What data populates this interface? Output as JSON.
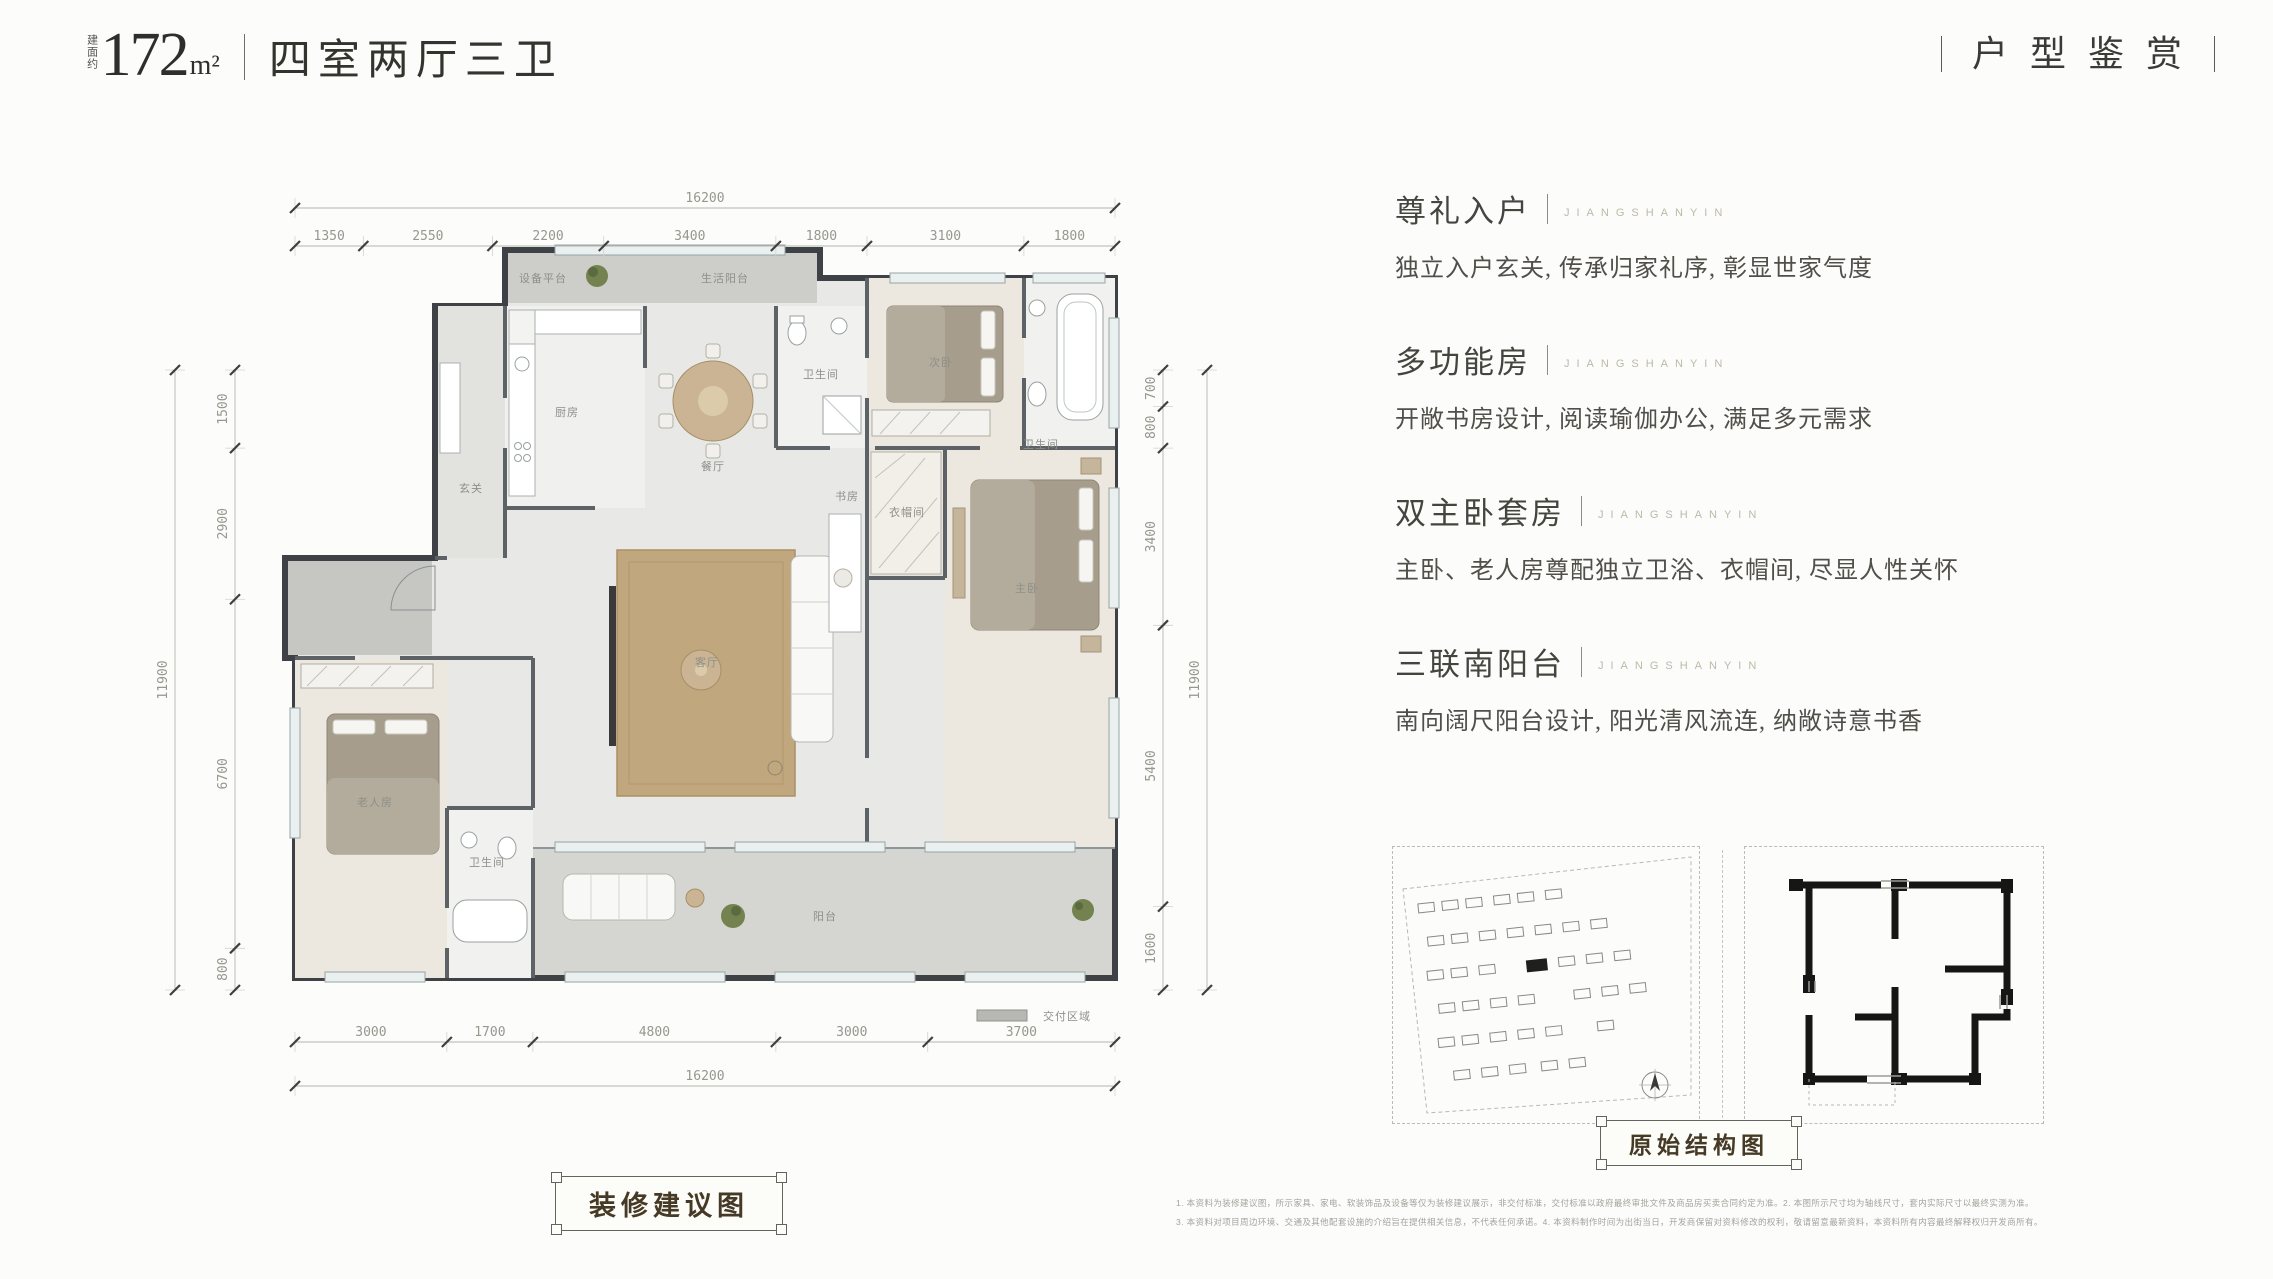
{
  "header": {
    "area_label_vertical": "建面约",
    "area_value": "172",
    "area_unit": "m²",
    "layout_title": "四室两厅三卫",
    "page_title": "户型鉴赏"
  },
  "plan": {
    "dims": {
      "top": {
        "total": "16200",
        "segments": [
          "1350",
          "2550",
          "2200",
          "3400",
          "1800",
          "3100",
          "1800"
        ]
      },
      "bottom": {
        "total": "16200",
        "segments": [
          "3000",
          "1700",
          "4800",
          "3000",
          "3700"
        ]
      },
      "left": {
        "total": "11900",
        "segments": [
          "1500",
          "2900",
          "6700",
          "800"
        ]
      },
      "right": {
        "total": "11900",
        "segments": [
          "700",
          "800",
          "3400",
          "5400",
          "1600"
        ]
      }
    },
    "room_labels": [
      "设备平台",
      "生活阳台",
      "厨房",
      "餐厅",
      "玄关",
      "卫生间",
      "次卧",
      "卫生间",
      "衣帽间",
      "主卧",
      "客厅",
      "书房",
      "老人房",
      "卫生间",
      "阳台"
    ],
    "legend_label": "交付区域",
    "caption": "装修建议图"
  },
  "features": [
    {
      "title": "尊礼入户",
      "tag": "JIANGSHANYIN",
      "desc": "独立入户玄关, 传承归家礼序, 彰显世家气度"
    },
    {
      "title": "多功能房",
      "tag": "JIANGSHANYIN",
      "desc": "开敞书房设计, 阅读瑜伽办公, 满足多元需求"
    },
    {
      "title": "双主卧套房",
      "tag": "JIANGSHANYIN",
      "desc": "主卧、老人房尊配独立卫浴、衣帽间, 尽显人性关怀"
    },
    {
      "title": "三联南阳台",
      "tag": "JIANGSHANYIN",
      "desc": "南向阔尺阳台设计, 阳光清风流连, 纳敞诗意书香"
    }
  ],
  "diagrams": {
    "structure_caption": "原始结构图"
  },
  "disclaimer": {
    "line1": "1. 本资料为装修建议图，所示家具、家电、软装饰品及设备等仅为装修建议展示，非交付标准，交付标准以政府最终审批文件及商品房买卖合同约定为准。2. 本图所示尺寸均为轴线尺寸，套内实际尺寸以最终实测为准。",
    "line2": "3. 本资料对项目周边环境、交通及其他配套设施的介绍旨在提供相关信息，不代表任何承诺。4. 本资料制作时间为出街当日，开发商保留对资料修改的权利，敬请留意最新资料，本资料所有内容最终解释权归开发商所有。"
  }
}
